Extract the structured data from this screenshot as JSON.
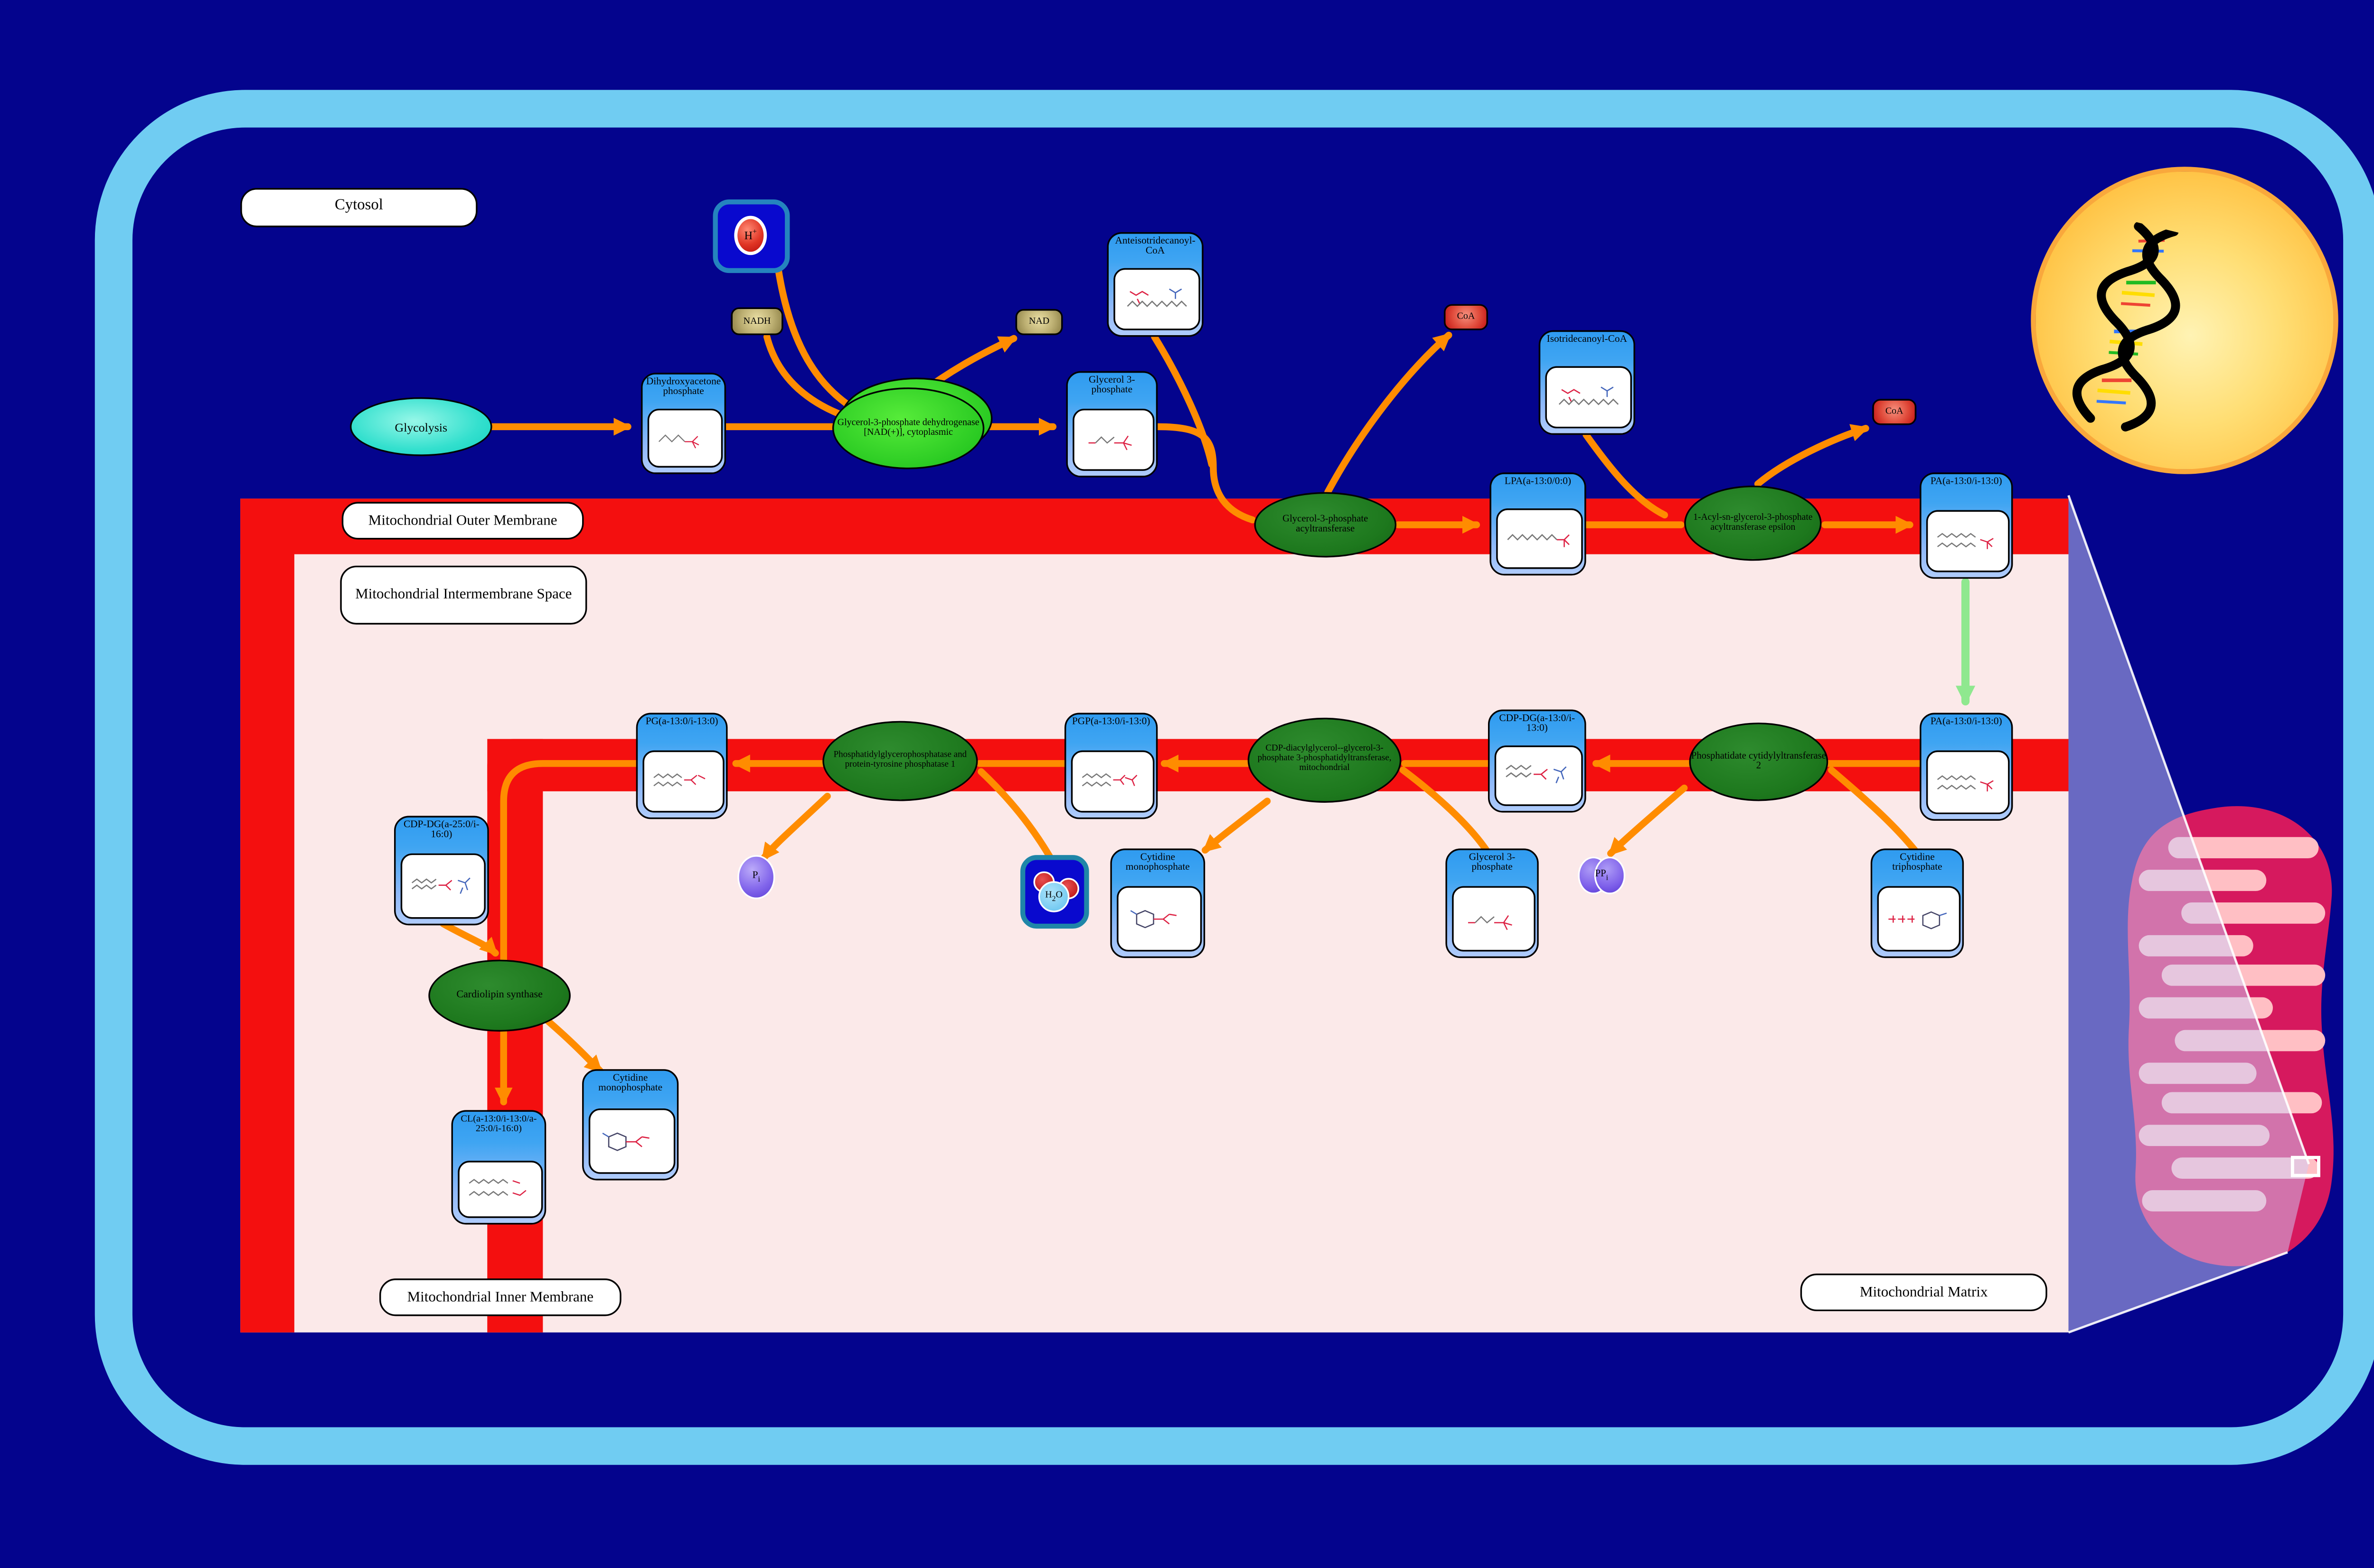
{
  "colors": {
    "background": "#04048D",
    "cell_border": "#70CCF2",
    "membrane_red": "#F40F0F",
    "intermembrane_pink": "#FBE9E9",
    "arrow_orange": "#FF8C00",
    "transport_arrow_green": "#8FE88F",
    "species_blue": "#2F9BF0",
    "enzyme_dark_green": "#1D781D",
    "enzyme_bright_green": "#2BCB23",
    "glycolysis_turquoise": "#34E0CE",
    "nucleus_yellow": "#FFC243",
    "mitochondrion_crimson": "#D6195E",
    "nad_khaki": "#BDB073",
    "coa_red": "#C21414",
    "phosphate_purple": "#7E60EA"
  },
  "compartments": {
    "cytosol": "Cytosol",
    "outer_membrane": "Mitochondrial Outer Membrane",
    "intermembrane_space": "Mitochondrial Intermembrane Space",
    "inner_membrane": "Mitochondrial Inner Membrane",
    "matrix": "Mitochondrial Matrix"
  },
  "pathway": {
    "glycolysis": "Glycolysis"
  },
  "enzymes": {
    "g3pdh": "Glycerol-3-phosphate dehydrogenase [NAD(+)], cytoplasmic",
    "gpat": "Glycerol-3-phosphate acyltransferase",
    "agpat": "1-Acyl-sn-glycerol-3-phosphate acyltransferase epsilon",
    "pcyt2": "Phosphatidate cytidylyltransferase 2",
    "cds": "CDP-diacylglycerol--glycerol-3-phosphate 3-phosphatidyltransferase, mitochondrial",
    "ptpmt": "Phosphatidylglycerophosphatase and protein-tyrosine phosphatase 1",
    "cls": "Cardiolipin synthase"
  },
  "species": {
    "dhap": "Dihydroxyacetone phosphate",
    "g3p_cytosol": "Glycerol 3-phosphate",
    "anteiso_coa": "Anteisotridecanoyl-CoA",
    "iso_coa": "Isotridecanoyl-CoA",
    "lpa": "LPA(a-13:0/0:0)",
    "pa_outer": "PA(a-13:0/i-13:0)",
    "pa_inner": "PA(a-13:0/i-13:0)",
    "cdpdg": "CDP-DG(a-13:0/i-13:0)",
    "pgp": "PGP(a-13:0/i-13:0)",
    "pg": "PG(a-13:0/i-13:0)",
    "cdpdg2": "CDP-DG(a-25:0/i-16:0)",
    "cl": "CL(a-13:0/i-13:0/a-25:0/i-16:0)",
    "cmp_1": "Cytidine monophosphate",
    "g3p_matrix": "Glycerol 3-phosphate",
    "ctp": "Cytidine triphosphate",
    "cmp_2": "Cytidine monophosphate"
  },
  "small_molecules": {
    "nadh": "NADH",
    "nad": "NAD",
    "coa_1": "CoA",
    "coa_2": "CoA",
    "h_plus": {
      "symbol": "H",
      "charge": "+"
    },
    "pi": {
      "main": "P",
      "sub": "i"
    },
    "ppi": {
      "main": "PP",
      "sub": "i"
    },
    "h2o": {
      "h": "H",
      "two": "2",
      "o": "O"
    }
  }
}
